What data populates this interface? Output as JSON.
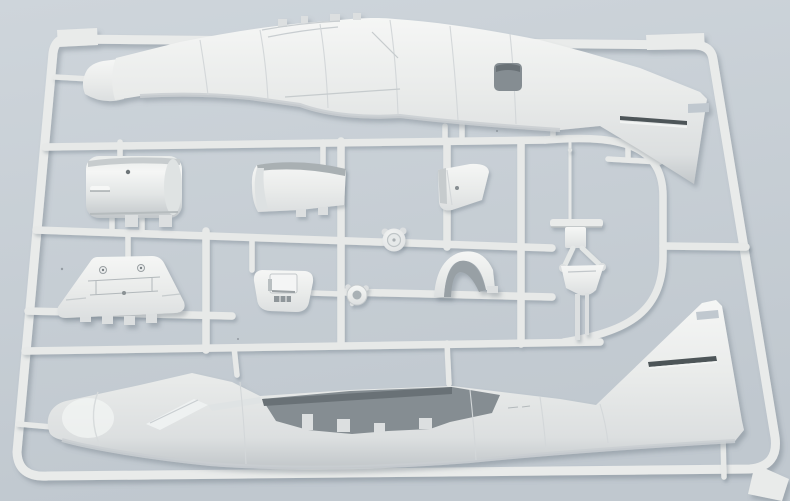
{
  "scene": {
    "subject": "Photograph of a light grey injection-molded model aircraft sprue: two fuselage halves and small detail parts attached to a rectangular runner frame, lying on a pale blue-grey surface",
    "medium": "photograph",
    "material": "light grey styrene plastic"
  },
  "colors": {
    "background_top": "#ced5db",
    "background_bottom": "#c0c8cf",
    "plastic": "#e9ebea",
    "plastic_bright": "#f5f6f5",
    "plastic_mid": "#dcdfe0",
    "plastic_shadow": "#c2c7ca",
    "runner": "#e7e9e8",
    "detail_dark": "#8a9196",
    "opening_top": "#697176",
    "opening_main": "#858d92",
    "slot_dark": "#4d5459",
    "inner_concave": "#98a0a5",
    "speck": "#6b737a"
  },
  "parts": {
    "frame": "sprue runner frame",
    "upper_fuselage": "fuselage half, inverted, tail fin lower right",
    "lower_fuselage": "fuselage half with open cockpit/wing bay, tail fin upper right",
    "nose_cone": "nose cone",
    "engine_cowling": "cylindrical cowling section",
    "deck_panel": "curved deck panel",
    "access_panel": "small access panel",
    "disc": "round disc part",
    "bulkhead": "fan-shaped bulkhead with bolt details",
    "cockpit_floor": "cockpit floor with raised box",
    "clamp_ring": "small ring fitting",
    "saddle_fairing": "curved saddle fairing",
    "gear_strut": "landing-gear strut assembly",
    "pitot_rod": "thin rod part"
  }
}
